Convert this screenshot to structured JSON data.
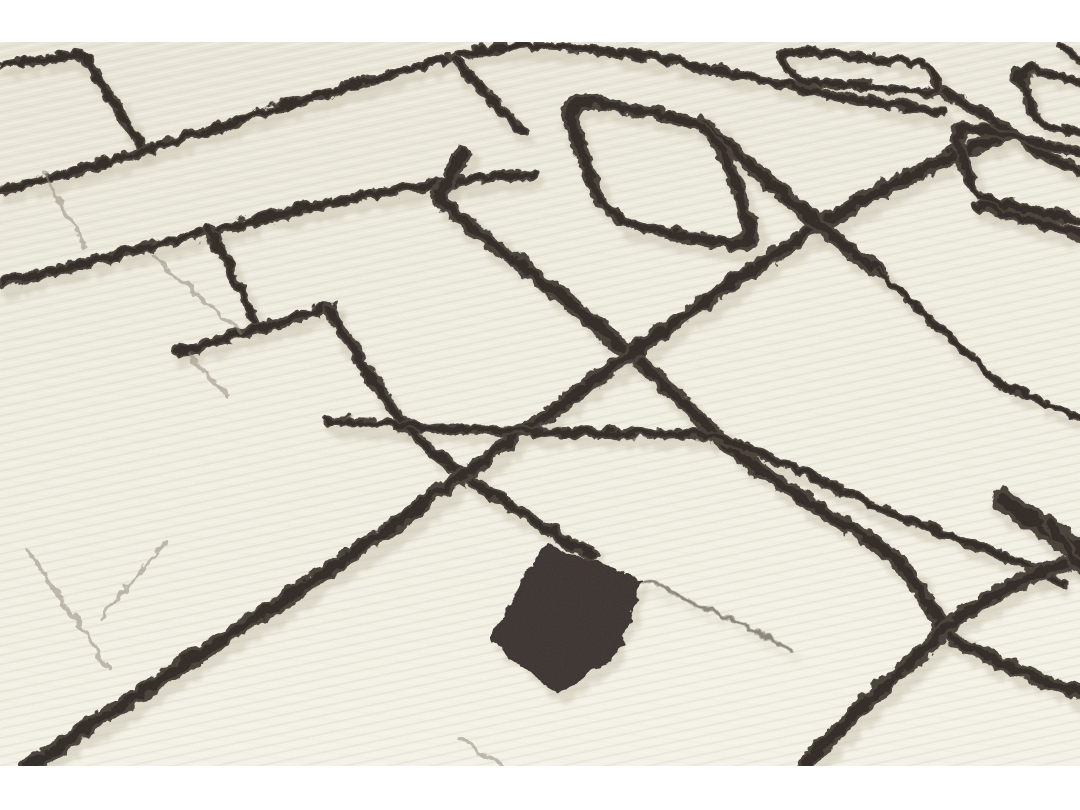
{
  "scene": {
    "kind": "product-photograph",
    "subject": "close-up of a handmade ivory wool shag rug with abstract dark geometric line pattern",
    "orientation": "angled perspective view, pile rows running diagonally",
    "matte_bands": {
      "top_height": 42,
      "photo_bottom": 766,
      "canvas_width": 1080,
      "canvas_height": 810
    }
  },
  "palette": {
    "matte": "#ffffff",
    "wool_top": "#eae7d9",
    "wool_mid": "#f2efe3",
    "wool_bottom": "#f7f5ea",
    "ridge_shadow": "#d5d0bd",
    "ridge_light": "#fbf9f0",
    "line_dark": "#3d3630",
    "line_core": "#2f2923",
    "line_alt": "#4a423a",
    "line_shadow": "#c9c3b0",
    "crease": "#938b7c"
  },
  "pattern": {
    "lines": [
      {
        "name": "hook-top-left",
        "d": "M 0 63 L 70 52 Q 80 51 86 61 L 140 146",
        "sw": 9
      },
      {
        "name": "long-line-upper",
        "d": "M 0 187 C 110 163 240 115 360 80 C 430 60 478 45 525 44 C 610 43 690 63 780 82 C 840 95 900 104 940 111",
        "sw": 10
      },
      {
        "name": "stub-top-center",
        "d": "M 451 57 L 520 130",
        "sw": 11
      },
      {
        "name": "long-line-mid-left",
        "d": "M 0 281 C 110 254 210 228 310 204 C 390 186 470 176 530 172",
        "sw": 11
      },
      {
        "name": "drop-line-left",
        "d": "M 206 227 C 223 253 240 287 252 320",
        "sw": 10
      },
      {
        "name": "short-line-left",
        "d": "M 176 349 C 220 338 270 322 330 305",
        "sw": 11
      },
      {
        "name": "steep-line-center",
        "d": "M 328 308 C 345 338 362 362 380 392 C 398 420 420 442 447 462 Q 470 480 500 498 C 530 518 560 535 590 552",
        "sw": 12
      },
      {
        "name": "hook-line-diagonal",
        "d": "M 461 150 L 440 186 Q 435 195 443 203 L 522 265 C 585 312 650 368 713 432 C 760 472 820 508 873 541 C 905 562 925 598 941 628 C 975 655 1030 675 1080 691",
        "sw": 15
      },
      {
        "name": "grand-diagonal",
        "d": "M 24 766 C 120 700 240 625 350 552 C 420 505 463 470 520 430 C 560 400 640 345 700 302 C 740 272 790 240 830 215 C 870 192 940 155 1004 132",
        "sw": 16
      },
      {
        "name": "mid-cross-line",
        "d": "M 324 419 C 390 423 470 427 540 430 C 600 432 672 430 714 434 C 775 455 850 497 928 526 C 965 540 1020 560 1060 580",
        "sw": 10
      },
      {
        "name": "bottom-right-line",
        "d": "M 799 766 C 830 732 868 696 908 661 C 925 645 933 637 942 629 C 962 609 996 588 1038 569 L 1080 555",
        "sw": 16
      },
      {
        "name": "ring-tail-thick",
        "d": "M 700 121 C 740 153 770 183 800 210 C 825 231 850 248 880 272",
        "sw": 15
      },
      {
        "name": "ring-tail-thin",
        "d": "M 875 270 C 915 305 955 342 1000 382 L 1080 418",
        "sw": 8
      },
      {
        "name": "rect-tail-right",
        "d": "M 941 90 C 965 101 985 114 1005 128 C 1032 147 1056 158 1080 169",
        "sw": 12
      },
      {
        "name": "ring-bottom-ext",
        "d": "M 975 203 L 1080 233",
        "sw": 12
      },
      {
        "name": "corner-mass-a",
        "d": "M 1000 496 L 1080 551",
        "sw": 24
      },
      {
        "name": "corner-mass-b",
        "d": "M 1046 520 L 1080 566",
        "sw": 14
      },
      {
        "name": "stub-top-right",
        "d": "M 1057 43 L 1080 57",
        "sw": 9
      },
      {
        "name": "faint-line-bottom",
        "d": "M 642 580 C 690 598 740 620 788 648",
        "sw": 5,
        "opacity": 0.35
      }
    ],
    "rings": [
      {
        "name": "big-ring",
        "w": 152,
        "h": 150,
        "rx": 34,
        "matrix": [
          1,
          0.18,
          0.32,
          0.84,
          558,
          94
        ],
        "sw": 17
      },
      {
        "name": "small-rect-top",
        "w": 150,
        "h": 38,
        "rx": 15,
        "matrix": [
          1,
          0.1,
          0.28,
          0.78,
          778,
          47
        ],
        "sw": 12
      },
      {
        "name": "edge-rect-upper",
        "w": 88,
        "h": 72,
        "rx": 20,
        "matrix": [
          1,
          0.25,
          0.28,
          0.8,
          1014,
          63
        ],
        "sw": 13
      },
      {
        "name": "edge-rect-lower",
        "w": 138,
        "h": 88,
        "rx": 20,
        "matrix": [
          1,
          0.22,
          0.25,
          0.85,
          951,
          121
        ],
        "sw": 14
      }
    ],
    "solids": [
      {
        "name": "dark-block",
        "d": "M 545 540 L 640 578 L 618 650 L 556 692 L 488 640 L 518 580 Z"
      }
    ],
    "creases": [
      {
        "name": "crease-1",
        "d": "M 43 170 L 83 245"
      },
      {
        "name": "crease-2",
        "d": "M 152 252 C 180 280 212 308 236 330"
      },
      {
        "name": "crease-3",
        "d": "M 186 352 C 200 366 214 381 228 396"
      },
      {
        "name": "crease-4",
        "d": "M 27 547 C 50 585 80 630 108 666"
      },
      {
        "name": "crease-5",
        "d": "M 165 538 C 142 565 117 592 98 618"
      },
      {
        "name": "crease-6",
        "d": "M 455 735 L 502 765"
      }
    ]
  }
}
